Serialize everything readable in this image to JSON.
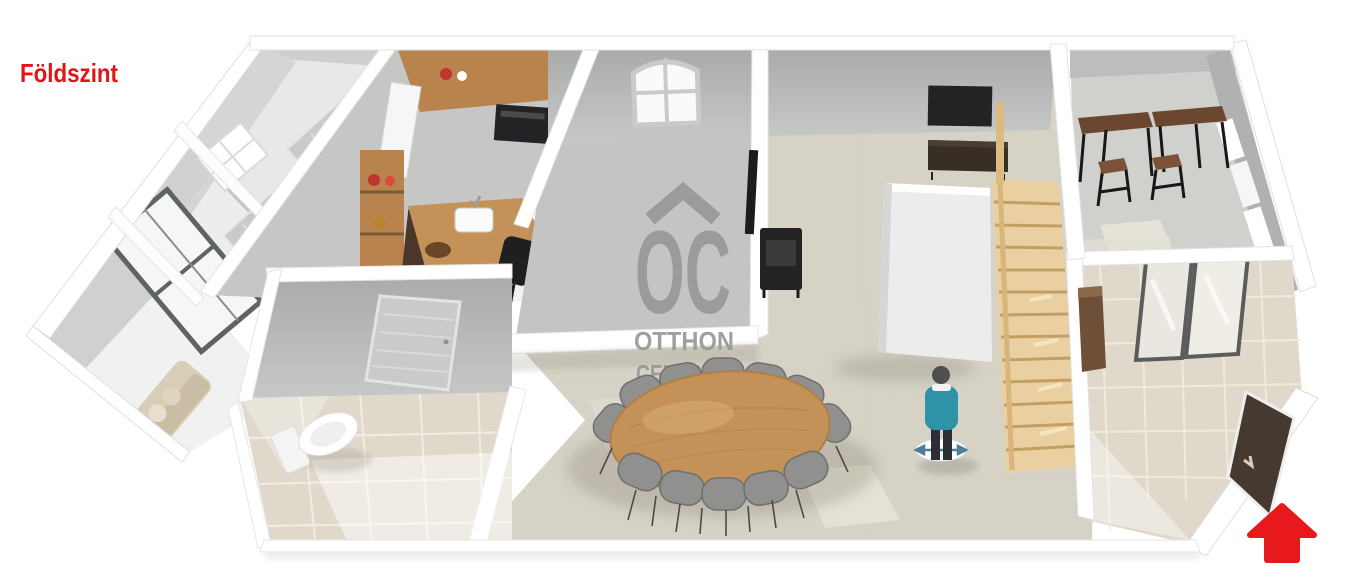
{
  "page": {
    "floor_label": "Földszint",
    "background": "#ffffff"
  },
  "watermark": {
    "monogram": "OC",
    "line1": "OTTHON",
    "line2": "CENTRUM"
  },
  "colors": {
    "label_red": "#e01515",
    "arrow_red": "#e8191d",
    "watermark_gray": "#979797",
    "wall_white": "#ffffff",
    "wall_face_light": "#dcdedd",
    "wall_face_mid": "#c3c5c4",
    "wall_face_dark": "#b0b2b1",
    "floor_room_gray": "#e7e9e8",
    "floor_living_beige": "#d6d2c6",
    "floor_tile_beige": "#e0d9cb",
    "floor_kitchen_gray": "#c6c7c5",
    "wood_counter": "#b8834c",
    "wood_table": "#c49258",
    "wood_dark": "#6b4730",
    "stair_wood": "#ead0a0",
    "stair_edge": "#c49f63",
    "appliance_black": "#232325",
    "sofa_beige": "#d8cdb6",
    "chair_gray": "#90908e",
    "person_shirt": "#2f93a8",
    "person_dark": "#2e2e35",
    "door_entry_dark": "#46392f",
    "glass_frame": "#5a5d5c"
  },
  "scene": {
    "type": "3d-floorplan-render",
    "objects": [
      "bedroom-windows",
      "large-framed-window",
      "arched-window",
      "kitchen-counter",
      "fridge",
      "oven",
      "kitchen-island-sink",
      "open-shelf",
      "bar-chairs",
      "bathroom-toilet",
      "bathroom-door",
      "sofa",
      "dining-table",
      "dining-chairs",
      "wood-stove",
      "tv",
      "sideboard",
      "staircase",
      "person-figure",
      "bar-tables",
      "bar-stools",
      "side-windows",
      "sliding-glass-door",
      "entry-door",
      "red-direction-arrow"
    ]
  }
}
